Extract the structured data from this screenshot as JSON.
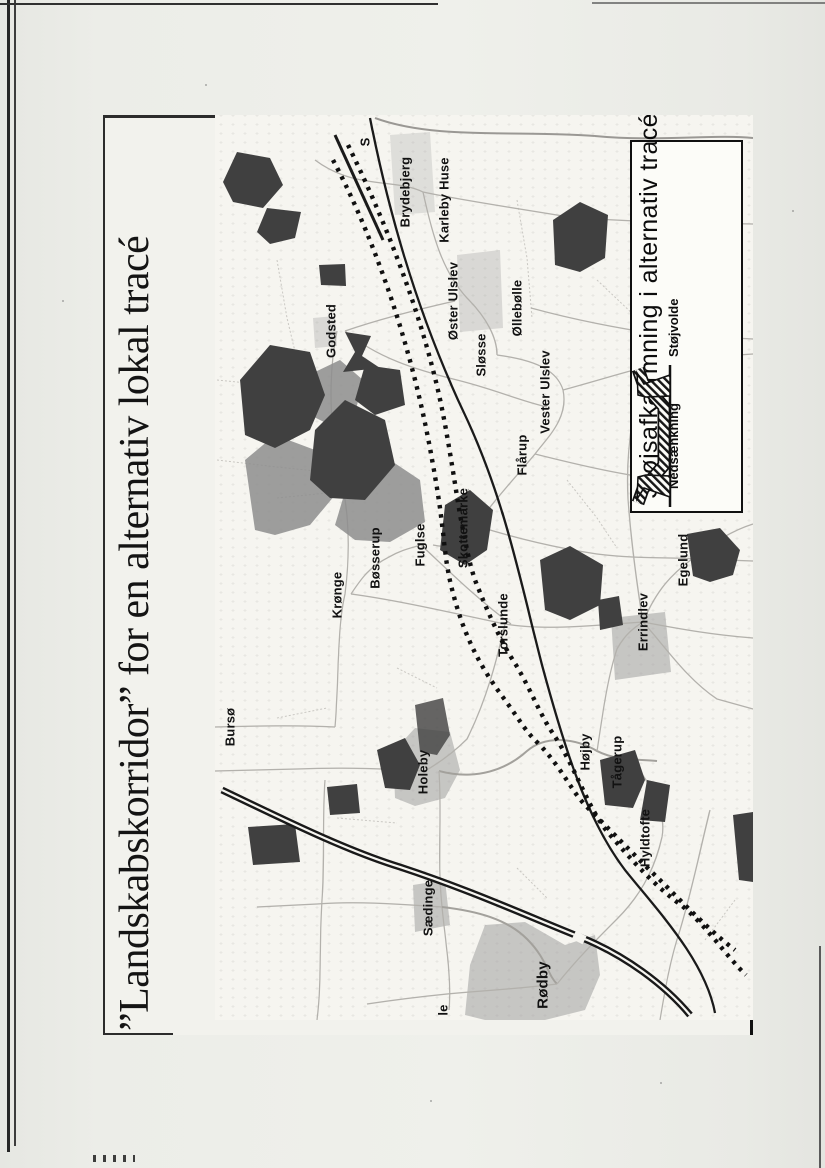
{
  "page": {
    "title": "”Landskabskorridor” for en alternativ lokal tracé",
    "paper_color": "#ecede8",
    "map_paper_color": "#f6f5f0",
    "ink_color": "#141414"
  },
  "legend": {
    "title": "Støjsafkærmning i alternativ tracé",
    "items": [
      {
        "label": "Nedsænkning",
        "icon": "sunken-road-profile-icon"
      },
      {
        "label": "Støjvolde",
        "icon": "noise-embankment-profile-icon"
      }
    ]
  },
  "map": {
    "colors": {
      "forest_dark": "#404040",
      "forest_mid": "#8d8d8d",
      "urban_gray": "#9f9f9f",
      "road_gray": "#b3b1ac",
      "line_black": "#141414"
    },
    "features": [
      {
        "name": "alternative-corridor-dotted-lines"
      },
      {
        "name": "existing-railway-solid-line"
      },
      {
        "name": "motorway-double-line"
      }
    ],
    "labels": [
      {
        "name": "S",
        "x": 878,
        "y": 150
      },
      {
        "name": "Brydebjerg",
        "x": 828,
        "y": 190
      },
      {
        "name": "Karleby Huse",
        "x": 820,
        "y": 229
      },
      {
        "name": "Godsted",
        "x": 689,
        "y": 116
      },
      {
        "name": "Øster Ulslev",
        "x": 719,
        "y": 238
      },
      {
        "name": "Sløsse",
        "x": 665,
        "y": 266
      },
      {
        "name": "Øllebølle",
        "x": 712,
        "y": 302
      },
      {
        "name": "Vester Ulslev",
        "x": 628,
        "y": 330
      },
      {
        "name": "Flårup",
        "x": 565,
        "y": 307
      },
      {
        "name": "Krønge",
        "x": 425,
        "y": 122
      },
      {
        "name": "Bøsserup",
        "x": 462,
        "y": 160
      },
      {
        "name": "Fuglse",
        "x": 475,
        "y": 205
      },
      {
        "name": "Skottemarke",
        "x": 492,
        "y": 248
      },
      {
        "name": "Torslunde",
        "x": 395,
        "y": 288
      },
      {
        "name": "Errindlev",
        "x": 398,
        "y": 428
      },
      {
        "name": "Egelund",
        "x": 460,
        "y": 468
      },
      {
        "name": "Bursø",
        "x": 293,
        "y": 15
      },
      {
        "name": "Holeby",
        "x": 248,
        "y": 208
      },
      {
        "name": "Højby",
        "x": 268,
        "y": 370
      },
      {
        "name": "Tågerup",
        "x": 258,
        "y": 402
      },
      {
        "name": "Hyldtofte",
        "x": 182,
        "y": 430
      },
      {
        "name": "Sædinge",
        "x": 112,
        "y": 213
      },
      {
        "name": "Rødby",
        "x": 35,
        "y": 328,
        "size": 15
      },
      {
        "name": "le",
        "x": 10,
        "y": 228
      }
    ]
  }
}
